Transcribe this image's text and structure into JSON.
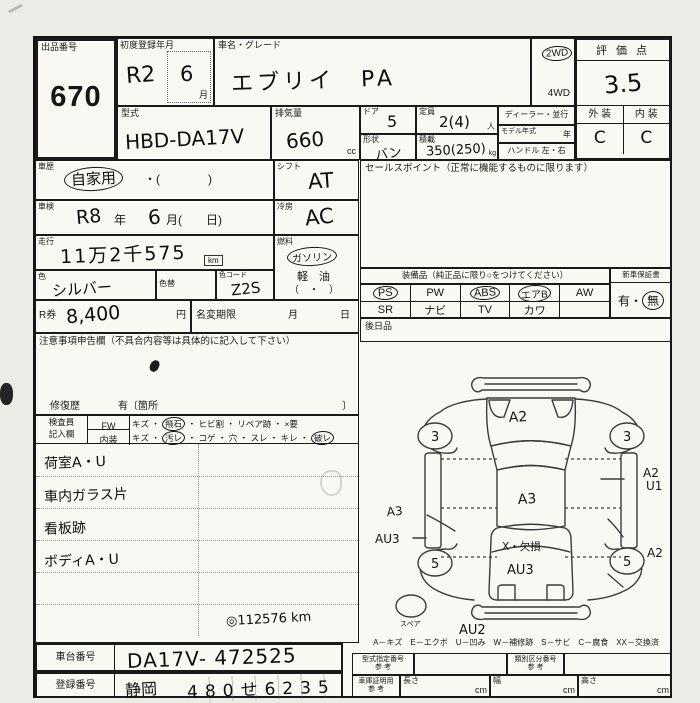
{
  "header": {
    "auction_no_label": "出品番号",
    "auction_no": "670",
    "first_reg_label": "初度登録年月",
    "first_reg_value": "R2",
    "first_reg_month": "6",
    "month_unit": "月",
    "car_name_label": "車名・グレード",
    "car_name": "エブリイ　PA",
    "drive_2wd": "2WD",
    "drive_4wd": "4WD",
    "score_label": "評 価 点",
    "score": "3.5",
    "exterior_label": "外 装",
    "interior_label": "内 装",
    "exterior_grade": "C",
    "interior_grade": "C",
    "model_label": "型式",
    "model_code": "HBD-DA17V",
    "displacement_label": "排気量",
    "displacement": "660",
    "displacement_unit": "cc",
    "door_label": "ドア",
    "door": "5",
    "capacity_label": "定員",
    "capacity": "2(4)",
    "capacity_unit": "人",
    "shape_label": "形状",
    "shape": "バン",
    "load_label": "積載",
    "load": "350(250)",
    "load_unit": "kg",
    "dealer_label": "ディーラー・並行",
    "model_year_label": "モデル年式",
    "year_unit": "年",
    "handle_label": "ハンドル 左・右"
  },
  "left": {
    "history_label": "車歴",
    "history_value": "自家用",
    "history_paren": "・(　　　　)",
    "shift_label": "シフト",
    "shift_value": "AT",
    "inspection_label": "車検",
    "inspection_era": "R8",
    "inspection_year_unit": "年",
    "inspection_month": "6",
    "inspection_month_paren": "月(　　日)",
    "cooling_label": "冷房",
    "cooling_value": "AC",
    "mileage_label": "走行",
    "mileage_value": "11万2千575",
    "mileage_unit": "km",
    "fuel_label": "燃料",
    "fuel_gasoline": "ガソリン",
    "fuel_diesel": "軽　油",
    "fuel_paren": "（　・　）",
    "color_label": "色",
    "color_value": "シルバー",
    "color_change_label": "色替",
    "color_code_label": "色コード",
    "color_code_value": "Z2S",
    "r_ticket_label": "R券",
    "r_ticket_value": "8,400",
    "yen_unit": "円",
    "name_change_label": "名変期限",
    "month_label": "月",
    "day_label": "日",
    "notice_label": "注意事項申告欄（不具合内容等は具体的に記入して下さい）",
    "repair_label": "修復歴",
    "repair_text": "有〔箇所",
    "repair_close": "〕",
    "inspector_label": "検査員",
    "entry_label": "記入欄",
    "fw_label": "FW",
    "fw_pre": "キズ ・",
    "fw_circled": "飛石",
    "fw_post": "・ ヒビ割 ・ リペア跡 ・ ×要",
    "int_label": "内装",
    "int_pre": "キズ ・",
    "int_circled1": "汚レ",
    "int_mid": "・ コゲ ・ 穴 ・ スレ ・ キレ ・",
    "int_circled2": "破レ",
    "note1": "荷室A・U",
    "note2": "車内ガラス片",
    "note3": "看板跡",
    "note4": "ボディA・U",
    "odo_note": "◎112576 km",
    "chassis_label": "車台番号",
    "chassis_value": "DA17V- 472525",
    "reg_label": "登録番号",
    "reg_area": "静岡",
    "reg_number": "480せ6235"
  },
  "right": {
    "sales_label": "セールスポイント（正常に機能するものに限ります）",
    "equip_label": "装備品（純正品に限り○をつけてください）",
    "equip_row1": [
      "PS",
      "PW",
      "ABS",
      "エアB",
      "AW"
    ],
    "equip_row2": [
      "SR",
      "ナビ",
      "TV",
      "カワ",
      ""
    ],
    "warranty_label": "新車保証書",
    "warranty_yes": "有",
    "warranty_sep": "・",
    "warranty_no": "無",
    "later_label": "後日品",
    "legend": "A－キズ　E－エクボ　U－凹み　W－補修跡　S－サビ　C－腐食　XX－交換済",
    "type_no_label": "型式指定番号",
    "ref_label": "参 考",
    "class_no_label": "類別区分番号",
    "garage_label": "車庫証明用",
    "length_label": "長さ",
    "width_label": "幅",
    "height_label": "高さ",
    "cm_unit": "cm"
  },
  "diagram": {
    "hood": "A2",
    "roof": "A3",
    "rear_window": "X・欠損",
    "rear_door": "AU3",
    "rear_bumper": "AU2",
    "left_side": "A3",
    "left_rocker": "AU3",
    "right_side_line1": "A2",
    "right_side_line2": "U1",
    "right_rear": "A2",
    "wheel_front_left": "3",
    "wheel_front_right": "3",
    "wheel_rear_left": "5",
    "wheel_rear_right": "5",
    "spare": "スペア"
  }
}
